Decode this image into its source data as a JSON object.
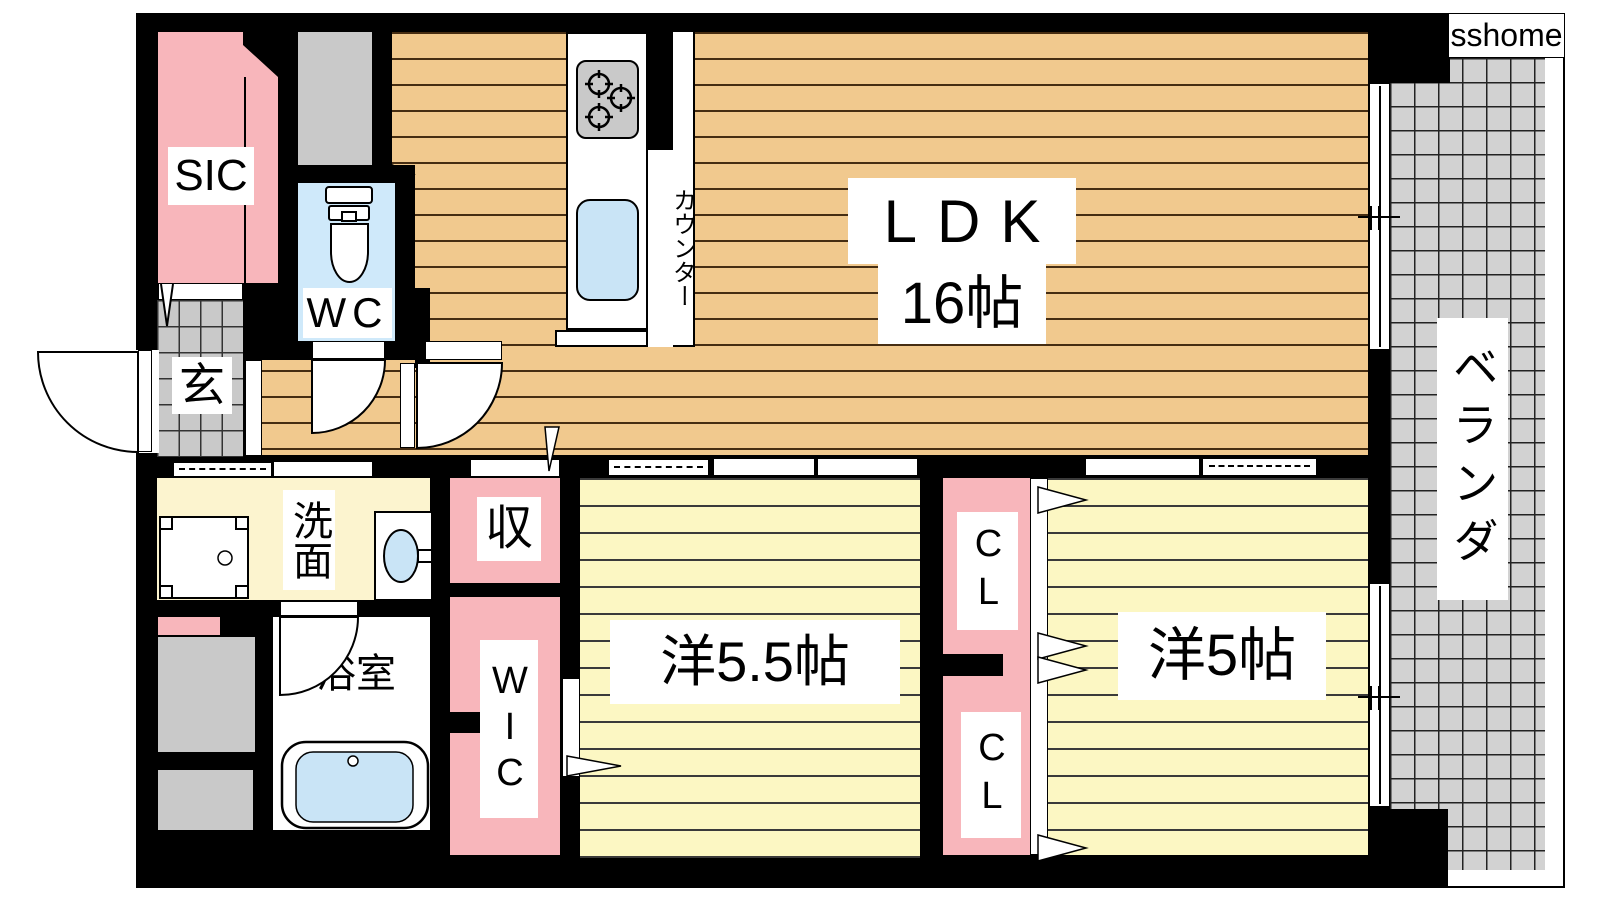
{
  "meta": {
    "type": "real-estate floor plan",
    "logo_text": "sshome"
  },
  "labels": {
    "sic": "SIC",
    "wc": "WC",
    "entrance": "玄",
    "ldk": "LDK",
    "ldk_size": "16帖",
    "counter": "カウンター",
    "veranda": "ベランダ",
    "washroom": "洗面",
    "bathroom": "浴室",
    "storage": "収",
    "wic": "WIC",
    "closet_upper": "CL",
    "closet_lower": "CL",
    "bedroom1": "洋5.5帖",
    "bedroom2": "洋5帖"
  },
  "colors": {
    "wall": "#000000",
    "wood_floor": "#f1c98e",
    "bedroom_floor": "#fcf7c3",
    "closet_pink": "#f8b6bb",
    "wc_blue": "#cfe9fa",
    "fixture_blue": "#c9e4f6",
    "tile_gray": "#c9c9c9",
    "veranda_gray": "#d2d2d2"
  }
}
